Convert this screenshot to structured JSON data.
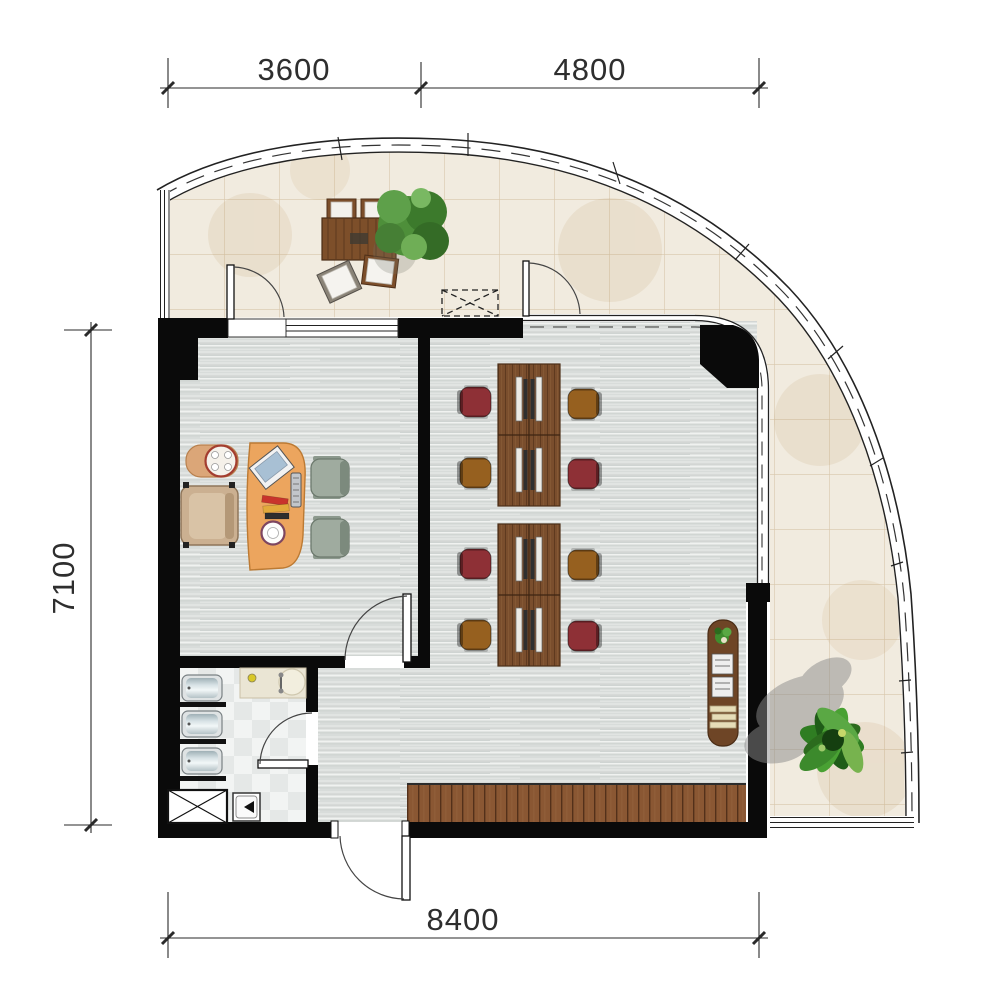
{
  "drawing": {
    "type": "office floor plan",
    "rooms": [
      "terrace",
      "manager-office",
      "open-office",
      "bathroom"
    ]
  },
  "dimensions": {
    "top_segment_1": "3600",
    "top_segment_2": "4800",
    "left_total": "7100",
    "bottom_total": "8400"
  },
  "colors": {
    "wall": "#0a0a0a",
    "terrace_tile": "#f1ebdf",
    "tile_grout": "#d8c7ab",
    "office_floor": "#e1e4e2",
    "deck_wood": "#8a5733",
    "workstation_wood": "#7a4e2d",
    "manager_desk": "#eca55e",
    "executive_chair": "#cbb091",
    "guest_chair": "#9fab9f",
    "task_chair_red": "#8e3036",
    "task_chair_brown": "#96601f",
    "plant_green": "#3f8d2e",
    "dimension_text": "#2e2e2e"
  },
  "furniture": {
    "workstations": "2 clusters of 4 desks with monitors and 8 task chairs",
    "manager_zone": "executive desk, executive chair, side table, 2 guest chairs",
    "bathroom": "3 fixtures, vanity counter, shower, service shaft",
    "terrace": "outdoor dining table with 4 chairs, 2 plants",
    "storage": "wall console cabinet"
  }
}
